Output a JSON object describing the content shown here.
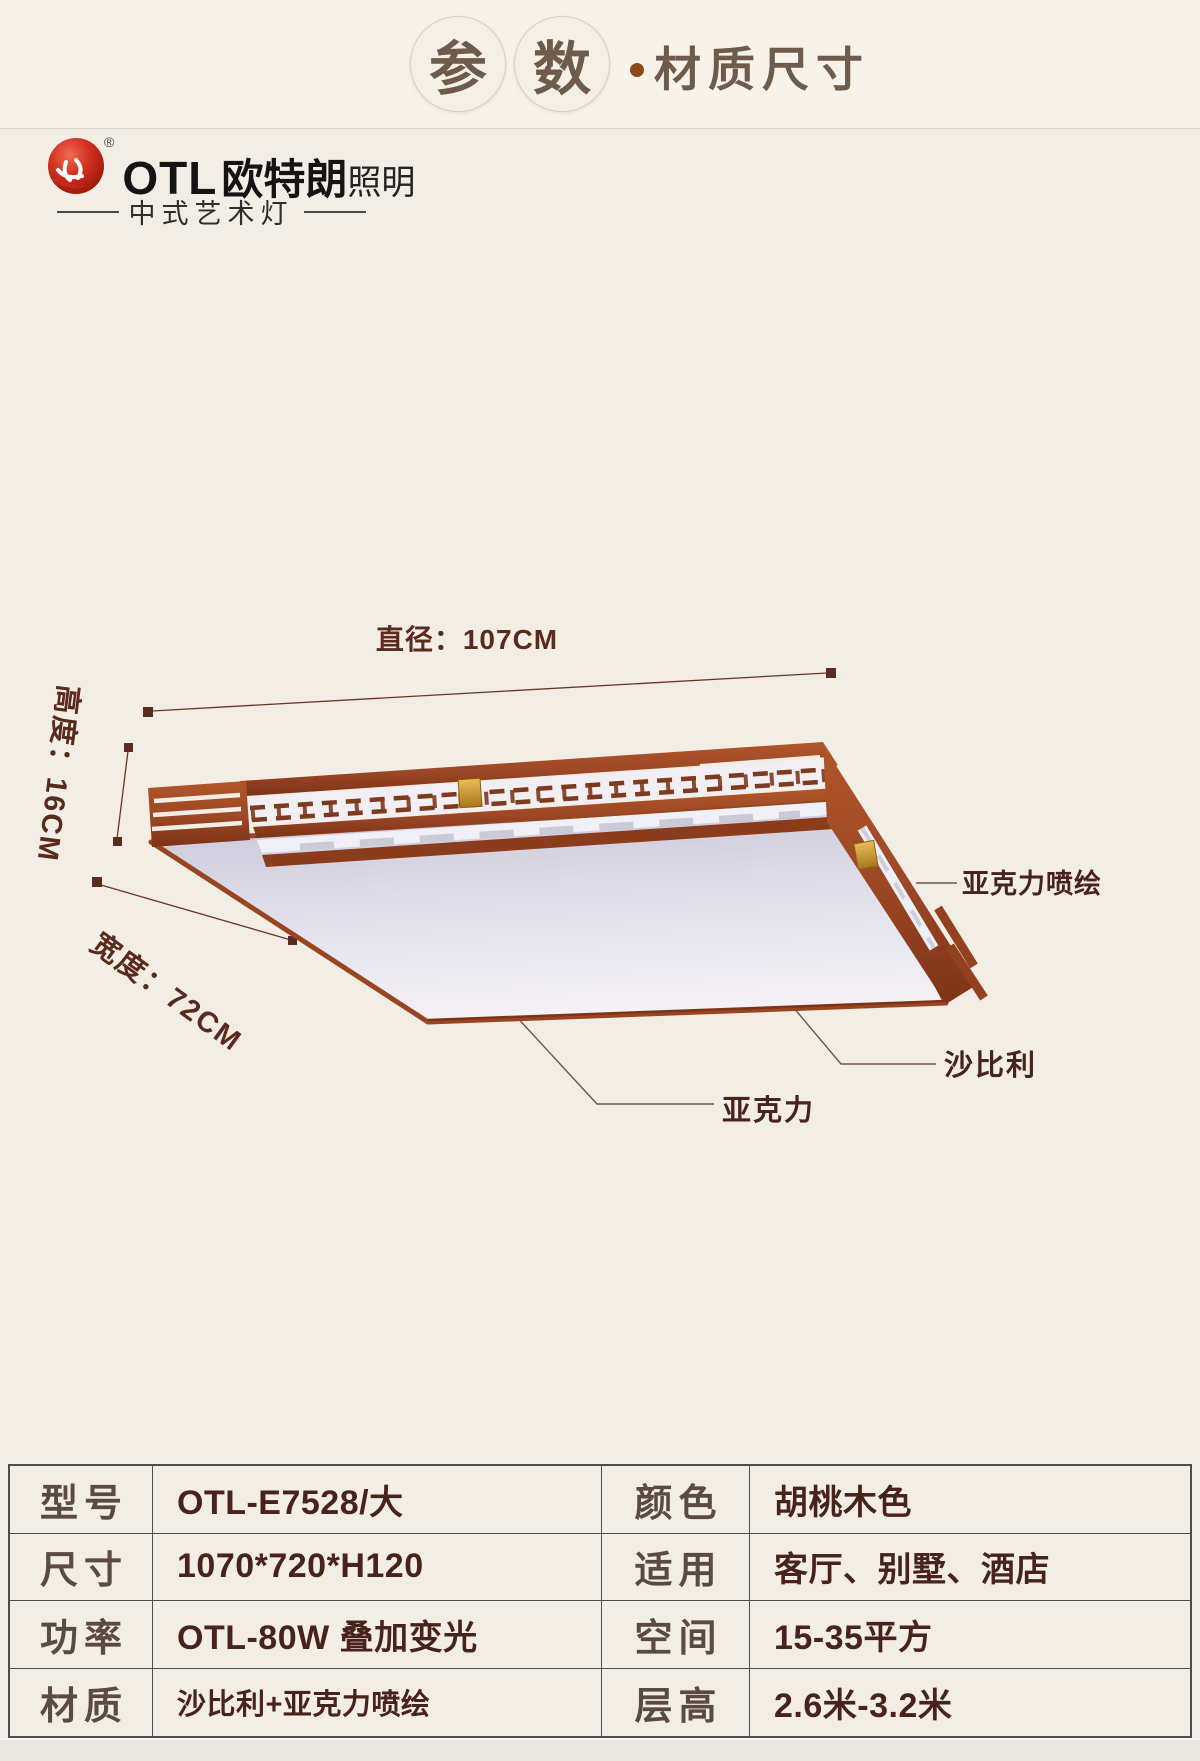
{
  "header": {
    "circle_chars": [
      "参",
      "数"
    ],
    "dot": "·",
    "subtitle": "材质尺寸"
  },
  "brand": {
    "registered_mark": "®",
    "logo_en": "OTL",
    "logo_cn": "欧特朗",
    "logo_suffix": "照明",
    "tagline": "中式艺术灯"
  },
  "diagram": {
    "dim_diameter": "直径：107CM",
    "dim_height": "高度：16CM",
    "dim_width": "宽度：72CM",
    "callout_acrylic_print": "亚克力喷绘",
    "callout_sapele": "沙比利",
    "callout_acrylic": "亚克力"
  },
  "spec_table": {
    "left_rows": [
      {
        "label": "型号",
        "value": "OTL-E7528/大"
      },
      {
        "label": "尺寸",
        "value": "1070*720*H120"
      },
      {
        "label": "功率",
        "value": "OTL-80W 叠加变光"
      },
      {
        "label": "材质",
        "value": "沙比利+亚克力喷绘"
      }
    ],
    "right_rows": [
      {
        "label": "颜色",
        "value": "胡桃木色"
      },
      {
        "label": "适用",
        "value": "客厅、别墅、酒店"
      },
      {
        "label": "空间",
        "value": "15-35平方"
      },
      {
        "label": "层高",
        "value": "2.6米-3.2米"
      }
    ]
  },
  "colors": {
    "page_bg": "#f3eee5",
    "wood": "#9c4726",
    "wood_dark": "#7c3316",
    "gold_accent": "#c9952c",
    "brand_red": "#c6281a",
    "heading_brown": "#6f5b4b",
    "dim_text": "#5a2a1d",
    "table_label": "#5b4a41",
    "table_value": "#47231c",
    "table_border": "#4d4d4d"
  }
}
